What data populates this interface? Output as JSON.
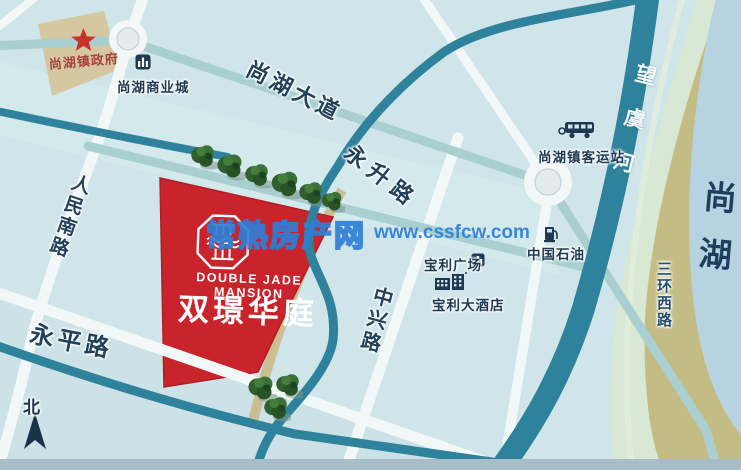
{
  "watermark": {
    "name": "常熟房产网",
    "url": "www.cssfcw.com",
    "accent_color": "#2e7fd6"
  },
  "project": {
    "name": "双璟华庭",
    "name_en": "DOUBLE JADE MANSION",
    "parcel_color": "#c9242b"
  },
  "roads": {
    "shanghu_avenue": "尚湖大道",
    "yongsheng": "永升路",
    "renmin_south": "人民南路",
    "yongping": "永平路",
    "zhongxing": "中兴路",
    "sanhuan_west": "三环西路"
  },
  "water": {
    "river": "望虞河",
    "lake": "尚湖"
  },
  "pois": {
    "government": "尚湖镇政府",
    "commercial_city": "尚湖商业城",
    "bus_station": "尚湖镇客运站",
    "petrochina": "中国石油",
    "baoli_plaza": "宝利广场",
    "baoli_hotel": "宝利大酒店"
  },
  "compass": {
    "north": "北"
  },
  "colors": {
    "map_background": "#cfe5e9",
    "river_teal": "#2e829b",
    "lake_blue": "#b7d3e2",
    "shore_olive": "#c3bd85",
    "government_parcel_tan": "#d5c8a0",
    "road_white": "#f2f7f7"
  }
}
